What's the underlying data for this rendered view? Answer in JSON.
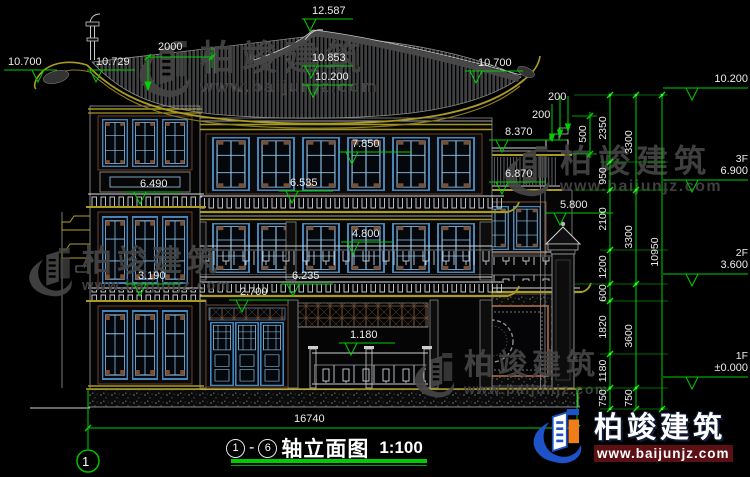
{
  "watermark": {
    "brand": "柏竣建筑",
    "url": "www.baijunjz.com"
  },
  "title": {
    "circle_left": "1",
    "separator": "-",
    "circle_right": "6",
    "text": "轴立面图",
    "scale": "1:100"
  },
  "axis": {
    "bubble": "1"
  },
  "levels": {
    "ridge": "12.587",
    "eave_left": "10.700",
    "eave_left2": "10.729",
    "mid_upper": "10.853",
    "mid_lower": "10.200",
    "eave_right": "10.700",
    "f3_win": "7.850",
    "f3_eave": "6.535",
    "tower_eave_up": "6.490",
    "wing_roof": "8.370",
    "wing_eave": "6.870",
    "pillar": "5.800",
    "f2_win": "4.800",
    "f2_eave": "6.235",
    "tower_eave_low": "3.190",
    "door": "2.700",
    "rail": "1.180",
    "right_top": "10.200",
    "f3_label": "3F",
    "f3_val": "6.900",
    "f2_label": "2F",
    "f2_val": "3.600",
    "f1_label": "1F",
    "f1_val": "±0.000"
  },
  "dims": {
    "top": "2000",
    "w200a": "200",
    "w200b": "200",
    "w500": "500",
    "fine": [
      "2350",
      "950",
      "2100",
      "1200",
      "600",
      "1820",
      "1180",
      "750"
    ],
    "floors": [
      "3300",
      "3300",
      "3600",
      "750"
    ],
    "total_v": "10950",
    "total_h": "16740"
  }
}
